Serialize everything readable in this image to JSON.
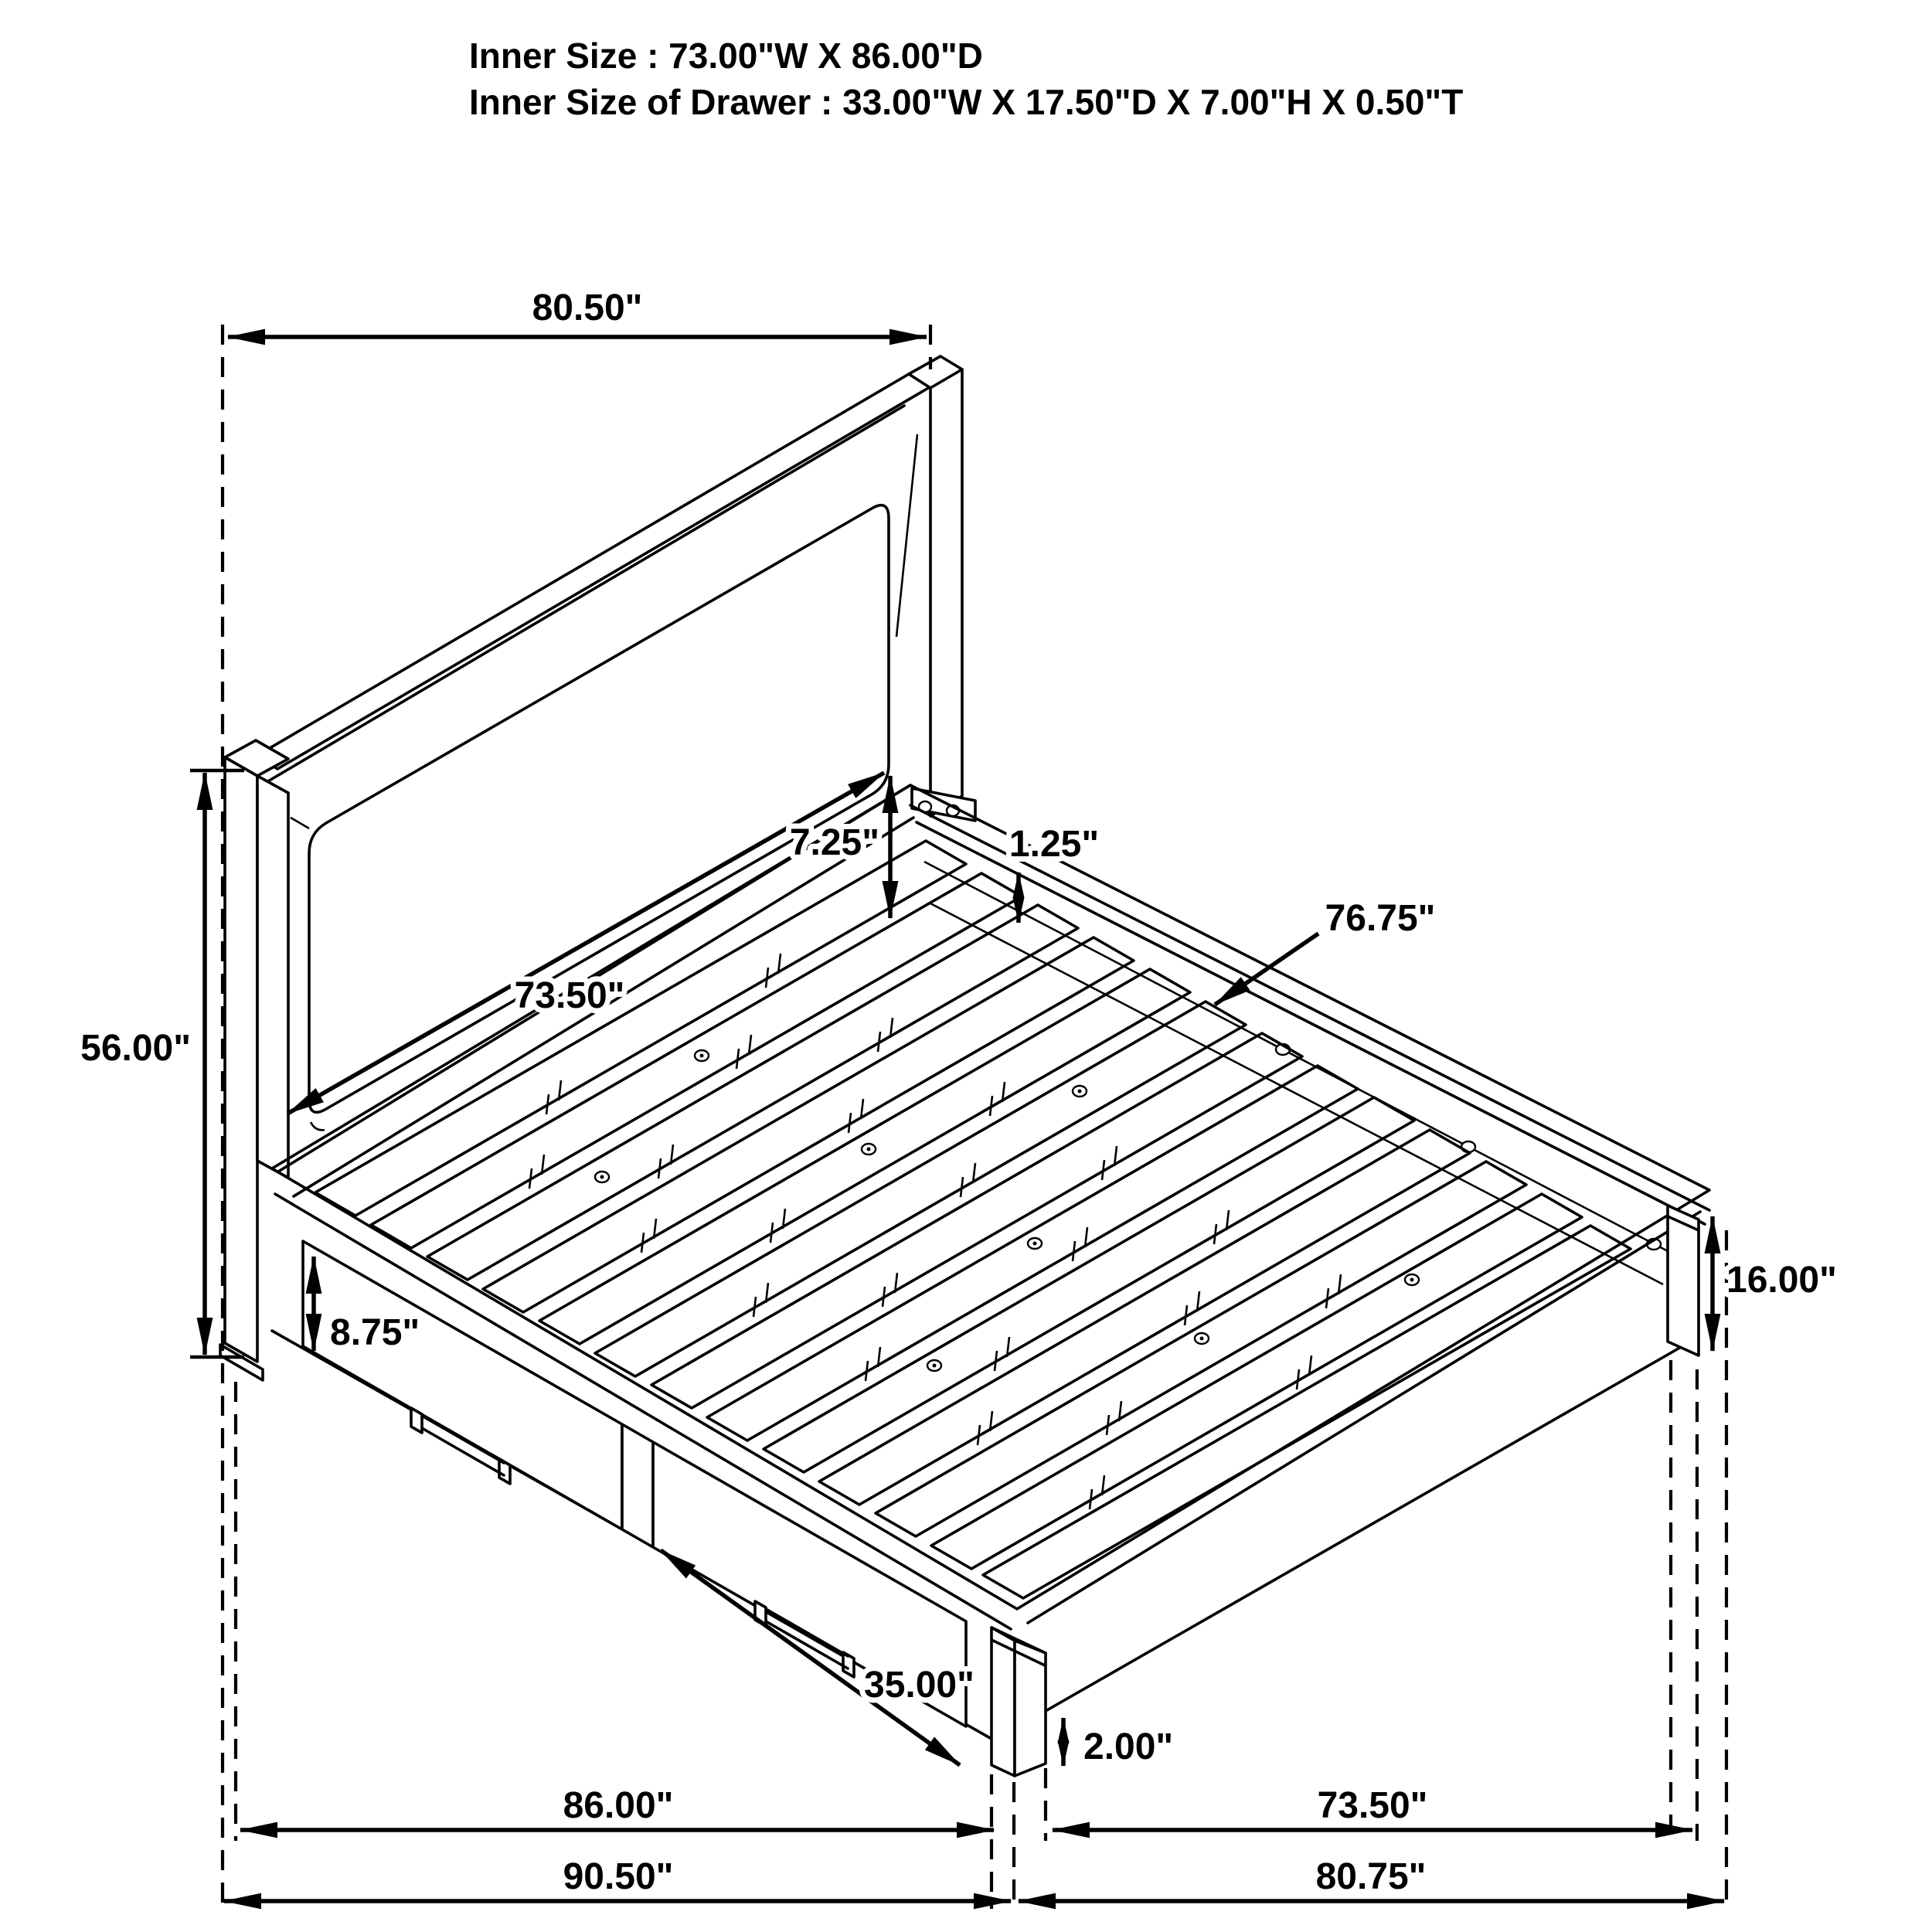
{
  "title": {
    "line1": "Inner Size : 73.00\"W X 86.00\"D",
    "line2": "Inner Size of Drawer : 33.00\"W X 17.50\"D X 7.00\"H X 0.50\"T"
  },
  "dimensions": {
    "headboard_width": "80.50\"",
    "headboard_height": "56.00\"",
    "headboard_inner_width": "73.50\"",
    "headboard_panel_gap": "7.25\"",
    "slat_lip_thickness": "1.25\"",
    "side_rail_length": "76.75\"",
    "drawer_front_height": "8.75\"",
    "drawer_width": "35.00\"",
    "platform_depth": "86.00\"",
    "overall_depth": "90.50\"",
    "floor_clearance": "2.00\"",
    "inner_width": "73.50\"",
    "overall_width": "80.75\"",
    "footboard_height": "16.00\""
  },
  "style": {
    "line_color": "#000000",
    "background": "#ffffff"
  }
}
